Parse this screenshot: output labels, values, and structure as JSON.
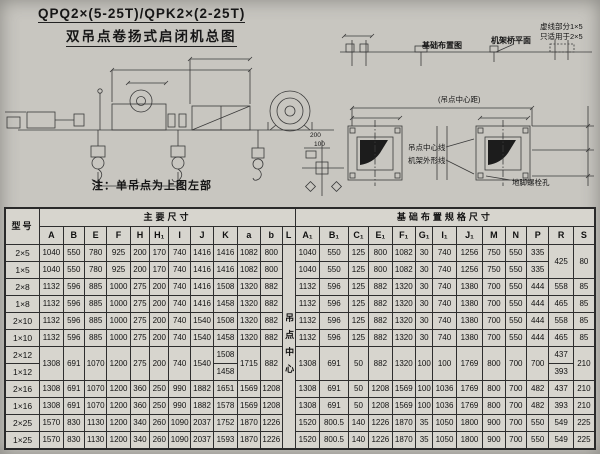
{
  "page": {
    "title_line1": "QPQ2×(5-25T)/QPK2×(2-25T)",
    "title_line2": "双吊点卷扬式启闭机总图",
    "note": "注：单吊点为上图左部"
  },
  "drawing_labels": {
    "foundation_plan": "基础布置图",
    "frame_bridge_plane": "机架桥平面",
    "dashed_note_line1": "虚线部分1×5",
    "dashed_note_line2": "只适用于2×5",
    "hoist_center_distance": "(吊点中心距)",
    "hoist_center_line": "吊点中心线",
    "frame_outline": "机架外形线",
    "anchor_bolt_hole": "地脚螺栓孔",
    "dim_200": "200",
    "dim_100": "100",
    "dim_L": "L"
  },
  "table": {
    "header_rows": [
      [
        {
          "t": "型号",
          "rs": 2,
          "cls": "model-h"
        },
        {
          "t": "主要尺寸",
          "cs": 12,
          "cls": "group-h"
        },
        {
          "t": "基础布置规格尺寸",
          "cs": 13,
          "cls": "group-h"
        }
      ],
      [
        "A",
        "B",
        "E",
        "F",
        "H",
        "H₁",
        "I",
        "J",
        "K",
        "a",
        "b",
        "L",
        "A₁",
        "B₁",
        "C₁",
        "E₁",
        "F₁",
        "G₁",
        "I₁",
        "J₁",
        "M",
        "N",
        "P",
        "R",
        "S"
      ]
    ],
    "rows": [
      [
        {
          "t": "2×5",
          "cls": "model"
        },
        "1040",
        "550",
        "780",
        "925",
        "200",
        "170",
        "740",
        "1416",
        "1416",
        "1082",
        "800",
        {
          "t": "吊点中心",
          "rs": 12,
          "cls": "vert"
        },
        "1040",
        "550",
        "125",
        "800",
        "1082",
        "30",
        "740",
        "1256",
        "750",
        "550",
        "335",
        {
          "t": "425",
          "rs": 2
        },
        {
          "t": "80",
          "rs": 2
        }
      ],
      [
        {
          "t": "1×5",
          "cls": "model"
        },
        "1040",
        "550",
        "780",
        "925",
        "200",
        "170",
        "740",
        "1416",
        "1416",
        "1082",
        "800",
        "1040",
        "550",
        "125",
        "800",
        "1082",
        "30",
        "740",
        "1256",
        "750",
        "550",
        "335"
      ],
      [
        {
          "t": "2×8",
          "cls": "model"
        },
        "1132",
        "596",
        "885",
        "1000",
        "275",
        "200",
        "740",
        "1416",
        "1508",
        "1320",
        "882",
        "1132",
        "596",
        "125",
        "882",
        "1320",
        "30",
        "740",
        "1380",
        "700",
        "550",
        "444",
        "558",
        "85"
      ],
      [
        {
          "t": "1×8",
          "cls": "model"
        },
        "1132",
        "596",
        "885",
        "1000",
        "275",
        "200",
        "740",
        "1416",
        "1458",
        "1320",
        "882",
        "1132",
        "596",
        "125",
        "882",
        "1320",
        "30",
        "740",
        "1380",
        "700",
        "550",
        "444",
        "465",
        "85"
      ],
      [
        {
          "t": "2×10",
          "cls": "model"
        },
        "1132",
        "596",
        "885",
        "1000",
        "275",
        "200",
        "740",
        "1540",
        "1508",
        "1320",
        "882",
        "1132",
        "596",
        "125",
        "882",
        "1320",
        "30",
        "740",
        "1380",
        "700",
        "550",
        "444",
        "558",
        "85"
      ],
      [
        {
          "t": "1×10",
          "cls": "model"
        },
        "1132",
        "596",
        "885",
        "1000",
        "275",
        "200",
        "740",
        "1540",
        "1458",
        "1320",
        "882",
        "1132",
        "596",
        "125",
        "882",
        "1320",
        "30",
        "740",
        "1380",
        "700",
        "550",
        "444",
        "465",
        "85"
      ],
      [
        {
          "t": "2×12",
          "cls": "model"
        },
        {
          "t": "1308",
          "rs": 2
        },
        {
          "t": "691",
          "rs": 2
        },
        {
          "t": "1070",
          "rs": 2
        },
        {
          "t": "1200",
          "rs": 2
        },
        {
          "t": "275",
          "rs": 2
        },
        {
          "t": "200",
          "rs": 2
        },
        {
          "t": "740",
          "rs": 2
        },
        {
          "t": "1540",
          "rs": 2
        },
        "1508",
        {
          "t": "1715",
          "rs": 2
        },
        {
          "t": "882",
          "rs": 2
        },
        {
          "t": "1308",
          "rs": 2
        },
        {
          "t": "691",
          "rs": 2
        },
        {
          "t": "50",
          "rs": 2
        },
        {
          "t": "882",
          "rs": 2
        },
        {
          "t": "1320",
          "rs": 2
        },
        {
          "t": "100",
          "rs": 2
        },
        {
          "t": "100",
          "rs": 2
        },
        {
          "t": "1769",
          "rs": 2
        },
        {
          "t": "800",
          "rs": 2
        },
        {
          "t": "700",
          "rs": 2
        },
        {
          "t": "700",
          "rs": 2
        },
        "437",
        {
          "t": "210",
          "rs": 2
        }
      ],
      [
        {
          "t": "1×12",
          "cls": "model"
        },
        "1458",
        "393"
      ],
      [
        {
          "t": "2×16",
          "cls": "model"
        },
        "1308",
        "691",
        "1070",
        "1200",
        "360",
        "250",
        "990",
        "1882",
        "1651",
        "1569",
        "1208",
        "1308",
        "691",
        "50",
        "1208",
        "1569",
        "100",
        "1036",
        "1769",
        "800",
        "700",
        "482",
        "437",
        "210"
      ],
      [
        {
          "t": "1×16",
          "cls": "model"
        },
        "1308",
        "691",
        "1070",
        "1200",
        "360",
        "250",
        "990",
        "1882",
        "1578",
        "1569",
        "1208",
        "1308",
        "691",
        "50",
        "1208",
        "1569",
        "100",
        "1036",
        "1769",
        "800",
        "700",
        "482",
        "393",
        "210"
      ],
      [
        {
          "t": "2×25",
          "cls": "model"
        },
        "1570",
        "830",
        "1130",
        "1200",
        "340",
        "260",
        "1090",
        "2037",
        "1752",
        "1870",
        "1226",
        "1520",
        "800.5",
        "140",
        "1226",
        "1870",
        "35",
        "1050",
        "1800",
        "900",
        "700",
        "550",
        "549",
        "225"
      ],
      [
        {
          "t": "1×25",
          "cls": "model"
        },
        "1570",
        "830",
        "1130",
        "1200",
        "340",
        "260",
        "1090",
        "2037",
        "1593",
        "1870",
        "1226",
        "1520",
        "800.5",
        "140",
        "1226",
        "1870",
        "35",
        "1050",
        "1800",
        "900",
        "700",
        "550",
        "549",
        "225"
      ]
    ]
  }
}
